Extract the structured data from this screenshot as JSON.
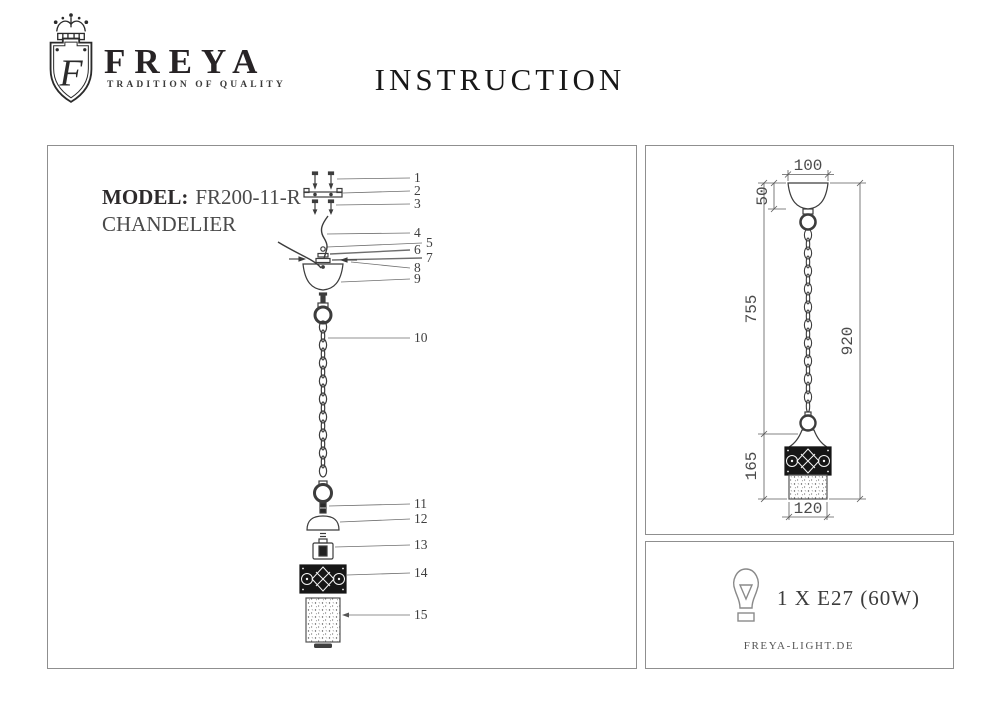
{
  "header": {
    "logo": {
      "monogram": "F",
      "brand": "FREYA",
      "tagline": "TRADITION OF QUALITY"
    },
    "title": "INSTRUCTION"
  },
  "left_panel": {
    "model_label": "MODEL:",
    "model_value": "FR200-11-R",
    "product_type": "CHANDELIER",
    "part_numbers": [
      "1",
      "2",
      "3",
      "4",
      "5",
      "6",
      "7",
      "8",
      "9",
      "10",
      "11",
      "12",
      "13",
      "14",
      "15"
    ]
  },
  "dimensions_panel": {
    "canopy_width": "100",
    "canopy_height": "50",
    "chain_length": "755",
    "total_height": "920",
    "shade_height": "165",
    "shade_width": "120"
  },
  "spec_panel": {
    "bulb_spec": "1 X E27 (60W)",
    "website": "FREYA-LIGHT.DE"
  },
  "colors": {
    "ink": "#231f20",
    "drawing_line": "#3c3c3c",
    "dim_text": "#4a4a4a",
    "panel_border": "#8f8f8f",
    "background": "#ffffff"
  }
}
